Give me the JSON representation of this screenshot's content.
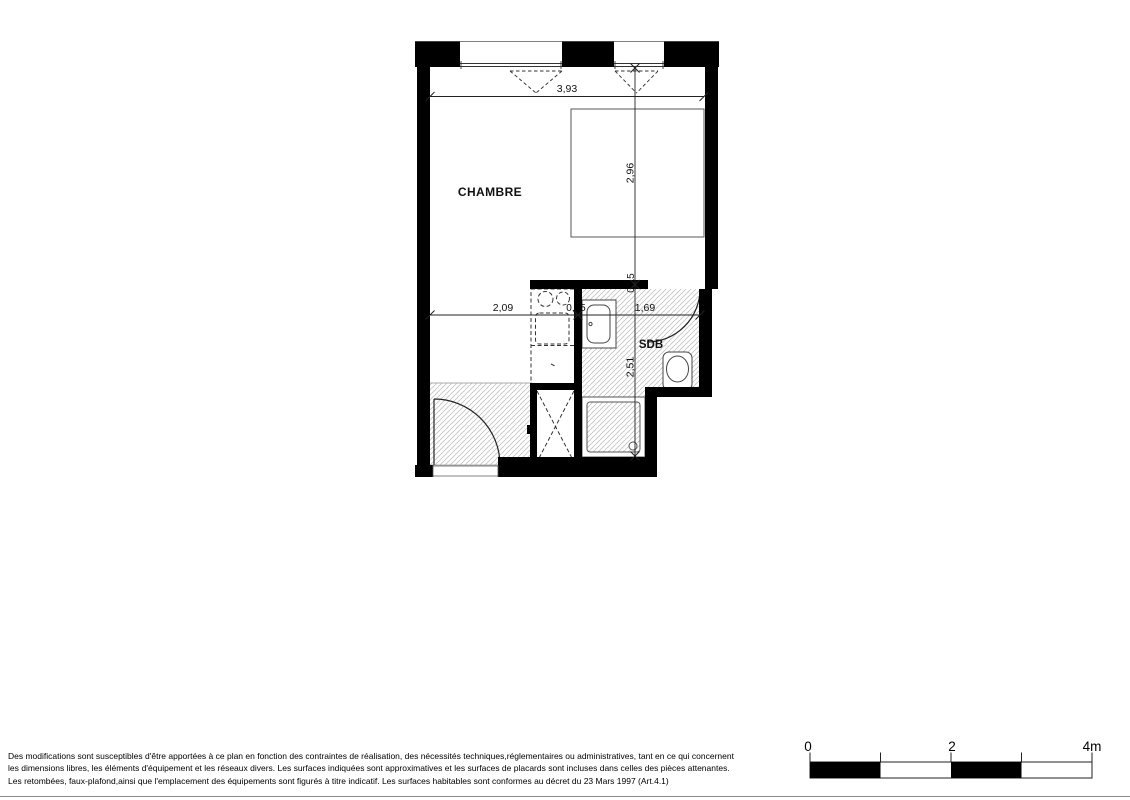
{
  "plan": {
    "room_labels": {
      "chambre": "CHAMBRE",
      "sdb": "SDB"
    },
    "dimensions": {
      "total_width_m": "3,93",
      "chambre_width_m": "2,09",
      "partition_thickness_h_m": "0,15",
      "sdb_width_m": "1,69",
      "chambre_depth_m": "2,96",
      "partition_thickness_v_m": "0,15",
      "sdb_depth_m": "2,51"
    }
  },
  "scale_bar": {
    "labels": {
      "zero": "0",
      "two": "2",
      "four": "4m"
    }
  },
  "footer": {
    "lines": [
      "Des modifications sont susceptibles d'être apportées à ce plan en fonction des contraintes de réalisation, des nécessités techniques,réglementaires ou administratives, tant en ce qui concernent",
      "les dimensions libres, les éléments d'équipement et les réseaux divers. Les surfaces indiquées sont approximatives et les surfaces de placards sont incluses dans celles des pièces attenantes.",
      "Les retombées, faux-plafond,ainsi que l'emplacement des équipements sont figurés à titre indicatif. Les surfaces habitables sont conformes au décret du 23 Mars 1997 (Art.4.1)"
    ]
  },
  "colors": {
    "wall": "#000000",
    "hatch_line": "#c2c2c2",
    "drawing_line": "#222222"
  }
}
